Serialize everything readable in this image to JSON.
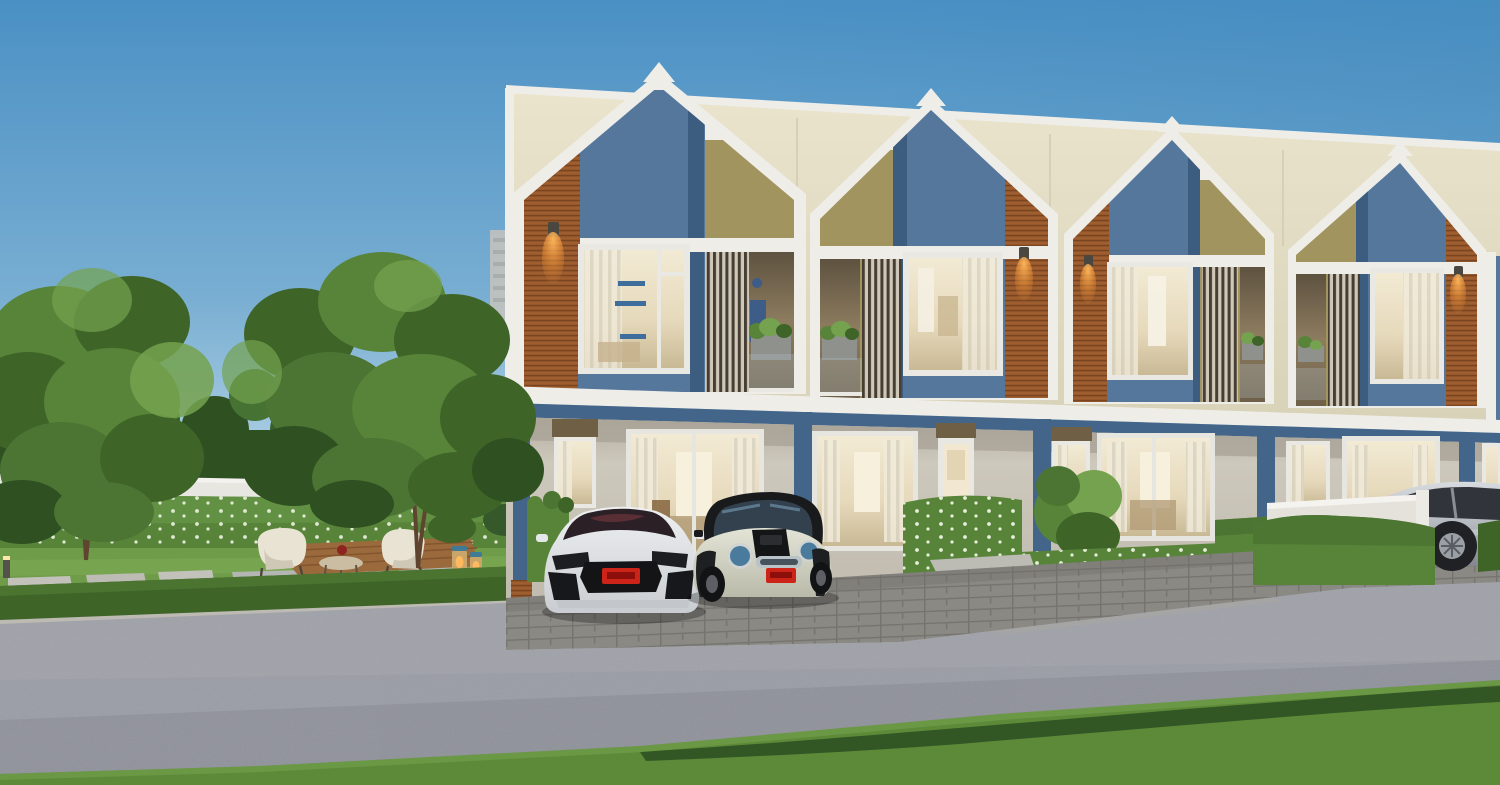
{
  "scene": {
    "description": "3D architectural rendering at dusk: a row of four modern two-storey gabled townhouses with white trim, steel-blue, wood-slat and khaki facade panels, warm lit windows and balconies; front garden with white perimeter wall, flowering hedges, trees, a wooden seating deck with two cream chairs, a coffee table and lanterns; a white sports coupe and a cream mini hatchback parked on a paver driveway, a silver sedan at the far right behind a low white wall; asphalt road and grass strip in the foreground",
    "time_of_day": "dusk",
    "objects": [
      "sky",
      "distant-high-rise",
      "distant-treeline",
      "perimeter-wall",
      "flowering-hedge",
      "lawn",
      "stepping-stones",
      "tree-left",
      "tree-right",
      "wooden-deck",
      "lounge-chair-left",
      "lounge-chair-right",
      "coffee-table",
      "red-bowl",
      "lanterns",
      "path-lights",
      "low-road-hedge",
      "townhouse-row",
      "gable-frames",
      "wood-slat-panels",
      "blue-panels",
      "khaki-panels",
      "upper-windows",
      "balcony-louvers",
      "balcony-planters",
      "wall-sconces",
      "resident-silhouette",
      "ground-floor-porch",
      "blue-pillars",
      "sliding-glass-doors",
      "entry-door",
      "transom-panels",
      "garden-shrubs",
      "flower-bed",
      "box-hedges",
      "low-white-wall",
      "paver-driveway",
      "sports-car-white",
      "mini-hatchback-cream",
      "sedan-silver",
      "asphalt-road",
      "curb",
      "foreground-grass"
    ],
    "building": {
      "visible_units": 4,
      "floors": 2,
      "panel_materials": [
        "wood slats",
        "steel blue",
        "khaki"
      ],
      "trim": "white",
      "parapet": "cream"
    },
    "cars": {
      "left": "white sports coupe, front view, dark windshield, red plate",
      "middle": "cream mini hatchback, black roof and bonnet stripes, blue-tinted lamps, red plate",
      "right": "silver sedan, front three-quarter, partially hidden by wall and hedge"
    }
  },
  "colors": {
    "sky_top": "#4a90c4",
    "sky_mid": "#79aed2",
    "sky_low": "#b7d6e7",
    "sky_horizon": "#dcecf2",
    "cream": "#eae4cd",
    "cream_dark": "#d8d2b8",
    "trim_white": "#efede8",
    "panel_blue": "#55779c",
    "mullion_blue": "#3d5d80",
    "khaki": "#a2945f",
    "wood": "#96572a",
    "wood_dark": "#6f3f1d",
    "pillar_blue": "#44658a",
    "wall_gray": "#cdc8bc",
    "porch_shade": "#a8a296",
    "transom_brown": "#6e5f45",
    "glass_warm": "#e6d9bb",
    "louver_dark": "#463e33",
    "green_light": "#74a24e",
    "green_mid": "#578438",
    "green_dark": "#3e6428",
    "green_deep": "#2f5122",
    "lawn": "#6f9c49",
    "flower_white": "#edf3e4",
    "deck_wood": "#9a693c",
    "road": "#979aa2",
    "curb": "#bcbab2",
    "paver": "#8b8984",
    "paver_gap": "#76746f",
    "car_white": "#eef0f1",
    "mini_cream": "#e3e4d6",
    "glass_dark": "#2e3138",
    "plate_red": "#cc2418",
    "silver": "#b4b9bf",
    "trunk_brown": "#5f4530",
    "glow_warm": "#ffb95e"
  }
}
